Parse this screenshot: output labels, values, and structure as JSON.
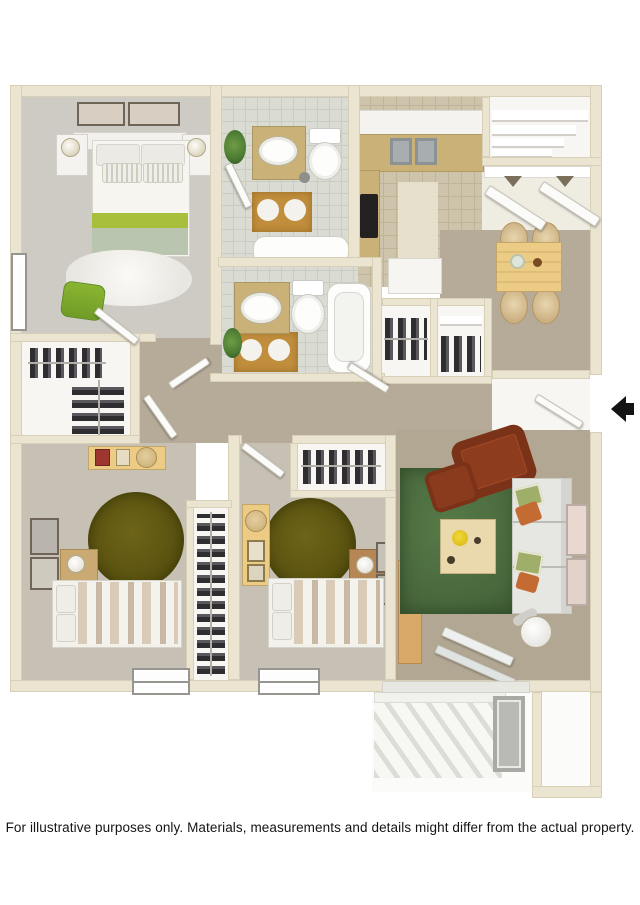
{
  "disclaimer": "For illustrative purposes only.  Materials, measurements and details might differ from the actual property.",
  "entry_arrow": {
    "glyph": "◀",
    "direction": "left"
  },
  "colors": {
    "wall": "#ebe4d1",
    "wall_edge": "#d8cfb7",
    "carpet_master": "#cecbc5",
    "carpet_bedroom": "#c7c1b5",
    "carpet_hall": "#b6ab99",
    "carpet_living": "#b1a793",
    "tile_bath": "#dadcd3",
    "tile_bath_line": "#c8ccc2",
    "tile_kitchen": "#cec4ac",
    "tile_kitchen_line": "#bfb497",
    "white_room": "#f7f6f2",
    "gold_mat": "#c08e3c",
    "counter": "#c9b177",
    "wood": "#eccb85",
    "wood_dark": "#d9a967",
    "olive_rug": "#57500f",
    "green_rug": "#49683d",
    "lime": "#a7bf3b",
    "sage": "#b9c5ae",
    "brown_chair": "#8e3c1e",
    "sofa": "#e6e6e3",
    "clothes_dark": "#2e2d30",
    "arrow": "#141414",
    "plant": "#4c7b33"
  }
}
